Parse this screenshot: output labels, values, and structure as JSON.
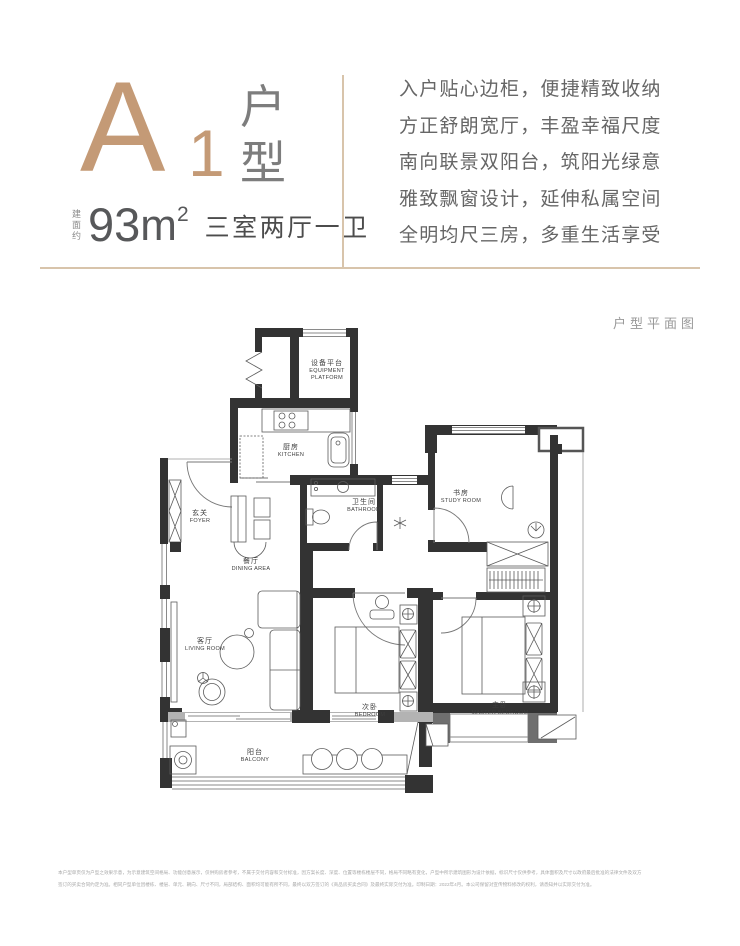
{
  "header": {
    "unit_letter": "A",
    "unit_number": "1",
    "unit_word_1": "户",
    "unit_word_2": "型",
    "area_prefix": "建面约",
    "area_value": "93",
    "area_unit_base": "m",
    "area_unit_sup": "2",
    "layout_summary": "三室两厅一卫"
  },
  "description": {
    "lines": [
      "入户贴心边柜，便捷精致收纳",
      "方正舒朗宽厅，丰盈幸福尺度",
      "南向联景双阳台，筑阳光绿意",
      "雅致飘窗设计，延伸私属空间",
      "全明均尺三房，多重生活享受"
    ]
  },
  "plan": {
    "caption": "户型平面图",
    "rooms": [
      {
        "cn": "设备平台",
        "en": "EQUIPMENT PLATFORM"
      },
      {
        "cn": "厨房",
        "en": "KITCHEN"
      },
      {
        "cn": "卫生间",
        "en": "BATHROOM"
      },
      {
        "cn": "书房",
        "en": "STUDY ROOM"
      },
      {
        "cn": "玄关",
        "en": "FOYER"
      },
      {
        "cn": "餐厅",
        "en": "DINING AREA"
      },
      {
        "cn": "客厅",
        "en": "LIVING ROOM"
      },
      {
        "cn": "次卧",
        "en": "BEDROOM"
      },
      {
        "cn": "主卧",
        "en": "MASTER BEDROOM"
      },
      {
        "cn": "阳台",
        "en": "BALCONY"
      }
    ]
  },
  "footer": {
    "disclaimer_line1": "本户型单页仅为户型之效果示意，为示意建筑空间格局、功能创意展示，仅供购房者参考，不属于交付内容和交付标准，因方案长度、深度、位置等楼栋楼层不同，格局不同略有变化，户型中所示建筑图形为设计依据，标识尺寸仅供参考，具体面积及尺寸以政府最后批准的法律文件及双方",
    "disclaimer_line2": "签订的买卖合同约定为准。相同户型单位因楼栋、楼层、单元、朝向、尺寸不同，局部结构、面积均可能有所不同，最终以双方签订的《商品房买卖合同》及最终实际交付为准。印制日期：2022年4月。本公司保留对宣传物料修改的权利，请悉知并以实际交付为准。"
  },
  "colors": {
    "accent_bronze": "#c49a76",
    "accent_line": "#d8c4ab",
    "wall": "#333333",
    "text_gray": "#666666"
  }
}
